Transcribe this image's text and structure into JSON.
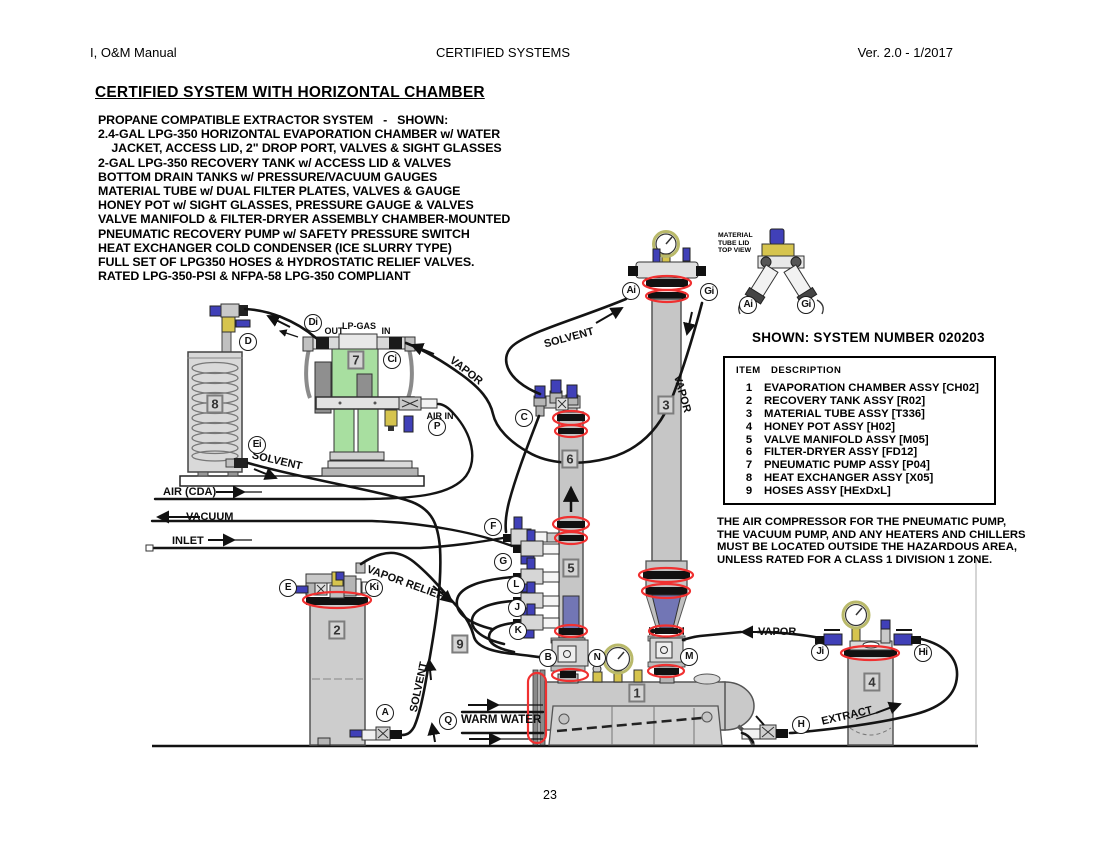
{
  "page": {
    "header_left": "I, O&M Manual",
    "header_center": "CERTIFIED SYSTEMS",
    "header_right": "Ver. 2.0 - 1/2017",
    "title": "CERTIFIED SYSTEM WITH HORIZONTAL CHAMBER",
    "description_lines": [
      "PROPANE COMPATIBLE EXTRACTOR SYSTEM   -   SHOWN:",
      "2.4-GAL LPG-350 HORIZONTAL EVAPORATION CHAMBER w/ WATER",
      "    JACKET, ACCESS LID, 2\" DROP PORT, VALVES & SIGHT GLASSES",
      "2-GAL LPG-350 RECOVERY TANK w/ ACCESS LID & VALVES",
      "BOTTOM DRAIN TANKS w/ PRESSURE/VACUUM GAUGES",
      "MATERIAL TUBE w/ DUAL FILTER PLATES, VALVES & GAUGE",
      "HONEY POT w/ SIGHT GLASSES, PRESSURE GAUGE & VALVES",
      "VALVE MANIFOLD & FILTER-DRYER ASSEMBLY CHAMBER-MOUNTED",
      "PNEUMATIC RECOVERY PUMP w/ SAFETY PRESSURE SWITCH",
      "HEAT EXCHANGER COLD CONDENSER (ICE SLURRY TYPE)",
      "FULL SET OF LPG350 HOSES & HYDROSTATIC RELIEF VALVES.",
      "RATED LPG-350-PSI & NFPA-58 LPG-350 COMPLIANT"
    ],
    "page_number": "23"
  },
  "parts_table": {
    "heading": "SHOWN: SYSTEM NUMBER 020203",
    "col_item": "ITEM",
    "col_description": "DESCRIPTION",
    "rows": [
      {
        "item": "1",
        "desc": "EVAPORATION CHAMBER ASSY [CH02]"
      },
      {
        "item": "2",
        "desc": "RECOVERY TANK ASSY [R02]"
      },
      {
        "item": "3",
        "desc": "MATERIAL TUBE ASSY [T336]"
      },
      {
        "item": "4",
        "desc": "HONEY POT ASSY [H02]"
      },
      {
        "item": "5",
        "desc": "VALVE MANIFOLD ASSY [M05]"
      },
      {
        "item": "6",
        "desc": "FILTER-DRYER ASSY [FD12]"
      },
      {
        "item": "7",
        "desc": "PNEUMATIC PUMP ASSY [P04]"
      },
      {
        "item": "8",
        "desc": "HEAT EXCHANGER ASSY [X05]"
      },
      {
        "item": "9",
        "desc": "HOSES ASSY [HExDxL]"
      }
    ]
  },
  "note_lines": [
    "THE AIR COMPRESSOR FOR THE PNEUMATIC PUMP,",
    "THE VACUUM PUMP, AND ANY HEATERS AND CHILLERS",
    "MUST BE LOCATED OUTSIDE THE HAZARDOUS AREA,",
    "UNLESS RATED FOR A CLASS 1 DIVISION 1 ZONE."
  ],
  "diagram": {
    "top_view_caption": [
      "MATERIAL",
      "TUBE LID",
      "TOP VIEW"
    ],
    "numbers": {
      "n1": "1",
      "n2": "2",
      "n3": "3",
      "n4": "4",
      "n5": "5",
      "n6": "6",
      "n7": "7",
      "n8": "8",
      "n9": "9"
    },
    "letters": {
      "D": "D",
      "Di": "Di",
      "Ci": "Ci",
      "P": "P",
      "Ei": "Ei",
      "C": "C",
      "E": "E",
      "Ki": "Ki",
      "F": "F",
      "G": "G",
      "L": "L",
      "J": "J",
      "K": "K",
      "B": "B",
      "N": "N",
      "M": "M",
      "A": "A",
      "Q": "Q",
      "H": "H",
      "Ji": "Ji",
      "Hi": "Hi",
      "Ai": "Ai",
      "Gi": "Gi"
    },
    "flow_labels": {
      "out": "OUT",
      "lp_gas": "LP-GAS",
      "in": "IN",
      "air_in": "AIR IN",
      "vapor_to_pump": "VAPOR",
      "solvent_hx": "SOLVENT",
      "air_cda": "AIR (CDA)",
      "vacuum": "VACUUM",
      "inlet": "INLET",
      "vapor_relief": "VAPOR RELIEF",
      "solvent_riser": "SOLVENT",
      "warm_water": "WARM WATER",
      "solvent_to_chamber": "SOLVENT",
      "vapor_tube": "VAPOR",
      "vapor_pot": "VAPOR",
      "extract": "EXTRACT"
    },
    "colors": {
      "highlight": "#f03030",
      "pump_green": "#a8dfa0",
      "valve_blue": "#4040b8",
      "brass_yellow": "#d6c44e",
      "indigo": "#7276b5",
      "vessel_gray": "#cdcdcd"
    }
  }
}
